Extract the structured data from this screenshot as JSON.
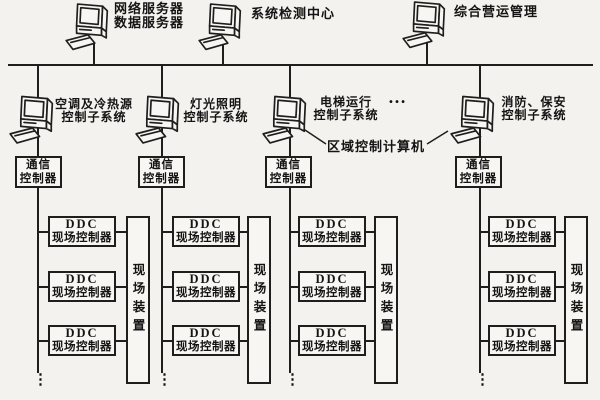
{
  "page": {
    "background_color": "#f3f2ee",
    "line_color": "#1e1e1e",
    "box_background": "#f7f6f2"
  },
  "top_nodes": [
    {
      "line1": "网络服务器",
      "line2": "数据服务器"
    },
    {
      "line1": "系统检测中心"
    },
    {
      "line1": "综合营运管理"
    }
  ],
  "area_computer_label": "区域控制计算机",
  "top_ellipsis": "…",
  "columns": [
    {
      "system_line1": "空调及冷热源",
      "system_line2": "控制子系统",
      "comm_line1": "通信",
      "comm_line2": "控制器",
      "ddc_line1": "DDC",
      "ddc_line2": "现场控制器",
      "device_label": "现场装置",
      "bottom_ellipsis": "⋮"
    },
    {
      "system_line1": "灯光照明",
      "system_line2": "控制子系统",
      "comm_line1": "通信",
      "comm_line2": "控制器",
      "ddc_line1": "DDC",
      "ddc_line2": "现场控制器",
      "device_label": "现场装置",
      "bottom_ellipsis": "⋮"
    },
    {
      "system_line1": "电梯运行",
      "system_line2": "控制子系统",
      "comm_line1": "通信",
      "comm_line2": "控制器",
      "ddc_line1": "DDC",
      "ddc_line2": "现场控制器",
      "device_label": "现场装置",
      "bottom_ellipsis": "⋮"
    },
    {
      "system_line1": "消防、保安",
      "system_line2": "控制子系统",
      "comm_line1": "通信",
      "comm_line2": "控制器",
      "ddc_line1": "DDC",
      "ddc_line2": "现场控制器",
      "device_label": "现场装置",
      "bottom_ellipsis": "⋮"
    }
  ]
}
